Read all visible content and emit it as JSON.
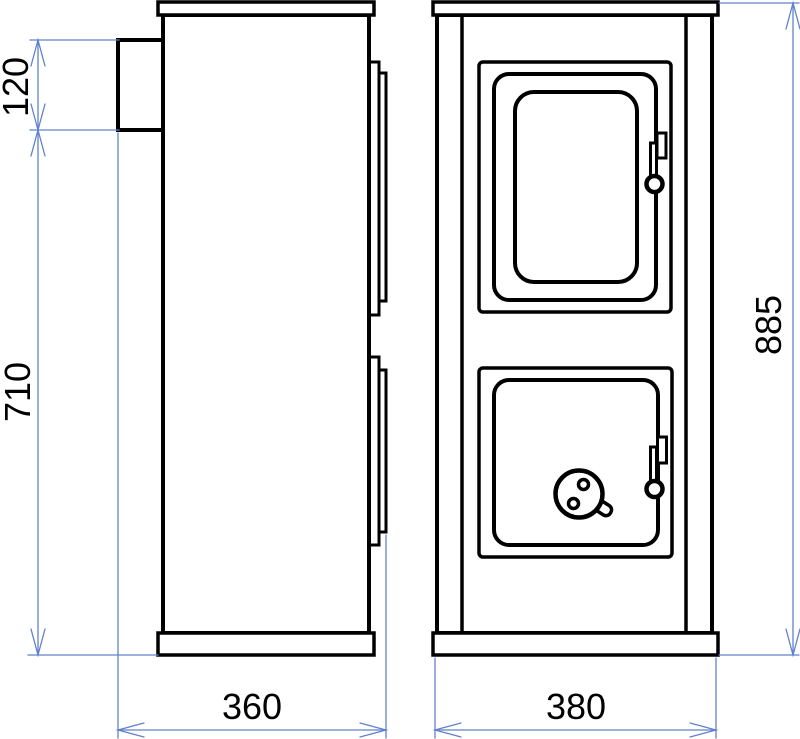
{
  "drawing": {
    "type": "technical-drawing",
    "views": {
      "left": "side-view",
      "right": "front-view"
    },
    "dimensions": {
      "flue_collar_height": "120",
      "body_height": "710",
      "overall_height": "885",
      "side_depth": "360",
      "front_width": "380"
    },
    "colors": {
      "outline": "#000000",
      "dimension_line": "#6282cb",
      "dimension_text": "#000000",
      "background": "#ffffff"
    }
  }
}
